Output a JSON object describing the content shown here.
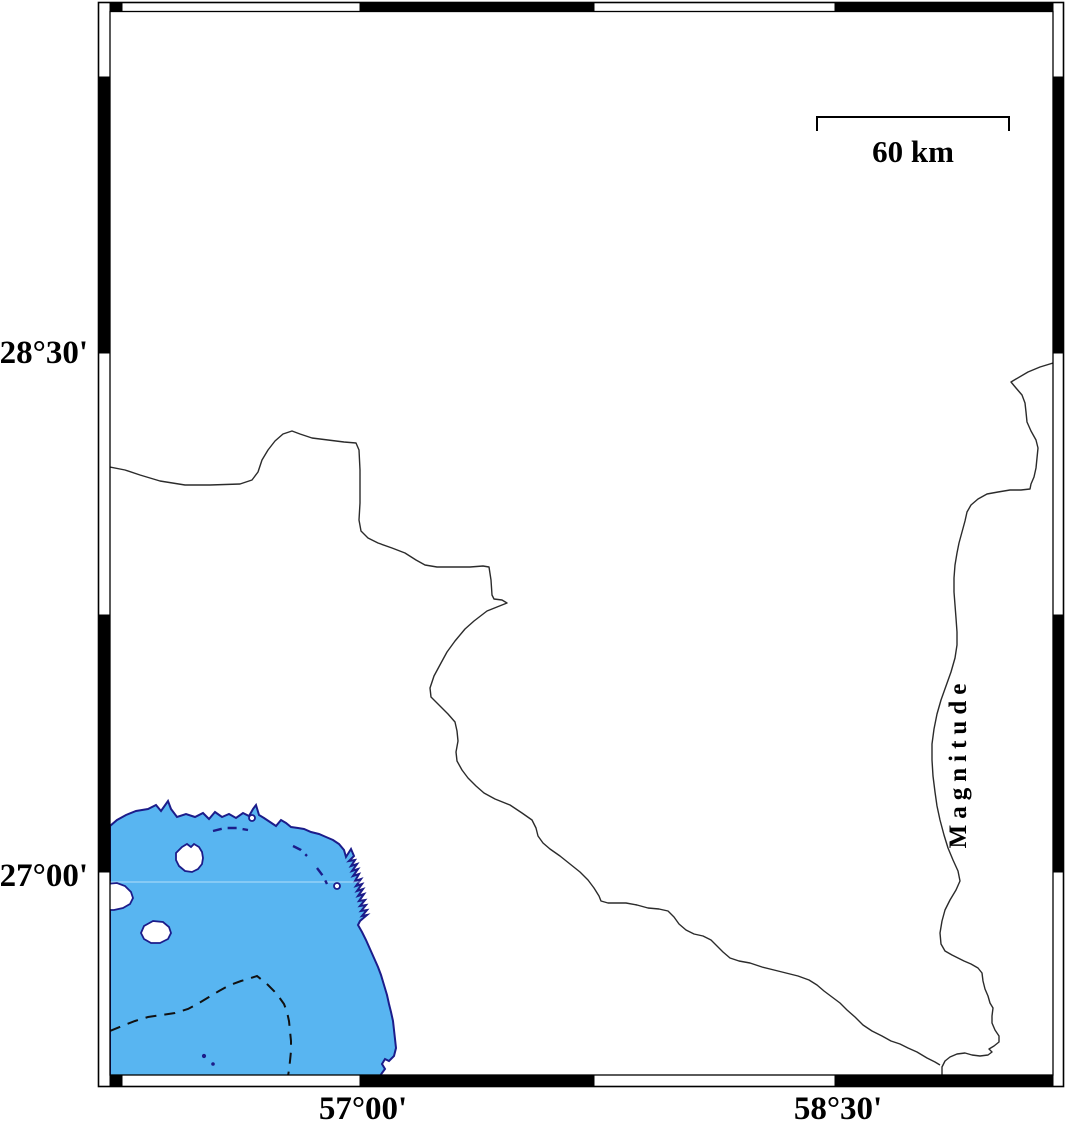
{
  "figure": {
    "lat_labels": [
      "28°30'",
      "27°00'"
    ],
    "lon_labels": [
      "57°00'",
      "58°30'"
    ],
    "scale_label": "60 km",
    "right_axis_label": "Magnitude",
    "colors": {
      "sea_fill": "#58b5f1",
      "coastline": "#1c1c8a",
      "boundary_line": "#2b2b2b",
      "frame": "#000000"
    }
  }
}
